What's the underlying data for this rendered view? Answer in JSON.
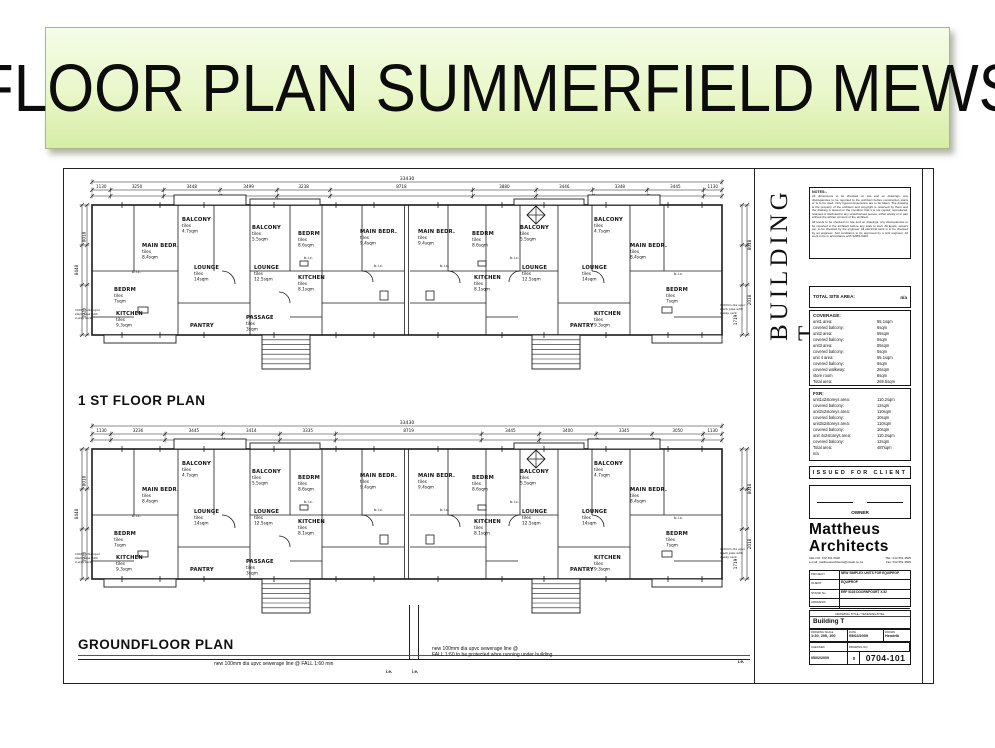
{
  "slide": {
    "title": "FLOOR PLAN SUMMERFIELD MEWS"
  },
  "drawing": {
    "building_label": "BUILDING T",
    "finish_label": "tiles",
    "plans": [
      {
        "name": "1 ST FLOOR PLAN",
        "dim_overall": "33430",
        "dims_top": [
          "1130",
          "3250",
          "3448",
          "3499",
          "3238",
          "8718",
          "3880",
          "3446",
          "3348",
          "3445",
          "1130"
        ],
        "dims_left": [
          "8448",
          "8018",
          "1925"
        ],
        "dims_right": [
          "8018",
          "2018",
          "1719"
        ],
        "compass": true,
        "bic_label": "b.i.c.",
        "bic": [
          [
            58,
            98
          ],
          [
            230,
            84
          ],
          [
            300,
            92
          ],
          [
            366,
            92
          ],
          [
            436,
            84
          ],
          [
            600,
            100
          ]
        ],
        "pipe_note": [
          "100mm dia upvc",
          "stack pipe with",
          "2-way vent"
        ],
        "rooms": [
          {
            "t": "BALCONY",
            "a": "4.7sqm",
            "x": 108,
            "y": 46
          },
          {
            "t": "MAIN BEDR.",
            "a": "8.4sqm",
            "x": 68,
            "y": 72
          },
          {
            "t": "LOUNGE",
            "a": "14sqm",
            "x": 120,
            "y": 94
          },
          {
            "t": "BEDRM",
            "a": "7sqm",
            "x": 40,
            "y": 116
          },
          {
            "t": "KITCHEN",
            "a": "9.3sqm",
            "x": 42,
            "y": 140
          },
          {
            "t": "BALCONY",
            "a": "5.5sqm",
            "x": 178,
            "y": 54
          },
          {
            "t": "LOUNGE",
            "a": "12.5sqm",
            "x": 180,
            "y": 94
          },
          {
            "t": "PASSAGE",
            "a": "3sqm",
            "x": 172,
            "y": 144
          },
          {
            "t": "BEDRM",
            "a": "8.6sqm",
            "x": 224,
            "y": 60
          },
          {
            "t": "KITCHEN",
            "a": "8.1sqm",
            "x": 224,
            "y": 104
          },
          {
            "t": "MAIN BEDR.",
            "a": "9.4sqm",
            "x": 286,
            "y": 58
          },
          {
            "t": "MAIN BEDR.",
            "a": "9.4sqm",
            "x": 344,
            "y": 58
          },
          {
            "t": "BEDRM",
            "a": "8.6sqm",
            "x": 398,
            "y": 60
          },
          {
            "t": "KITCHEN",
            "a": "8.1sqm",
            "x": 400,
            "y": 104
          },
          {
            "t": "BALCONY",
            "a": "5.5sqm",
            "x": 446,
            "y": 54
          },
          {
            "t": "LOUNGE",
            "a": "12.5sqm",
            "x": 448,
            "y": 94
          },
          {
            "t": "BALCONY",
            "a": "4.7sqm",
            "x": 520,
            "y": 46
          },
          {
            "t": "LOUNGE",
            "a": "14sqm",
            "x": 508,
            "y": 94
          },
          {
            "t": "MAIN BEDR.",
            "a": "8.4sqm",
            "x": 556,
            "y": 72
          },
          {
            "t": "BEDRM",
            "a": "7sqm",
            "x": 592,
            "y": 116
          },
          {
            "t": "KITCHEN",
            "a": "9.3sqm",
            "x": 520,
            "y": 140
          },
          {
            "t": "PANTRY",
            "a": null,
            "x": 116,
            "y": 152
          },
          {
            "t": "PANTRY",
            "a": null,
            "x": 496,
            "y": 152
          }
        ]
      },
      {
        "name": "GROUNDFLOOR PLAN",
        "dim_overall": "33430",
        "dims_top": [
          "1130",
          "3236",
          "3445",
          "3414",
          "3335",
          "8719",
          "3445",
          "3400",
          "3345",
          "3050",
          "1130"
        ],
        "dims_left": [
          "8448",
          "8018",
          "1925"
        ],
        "dims_right": [
          "8018",
          "2018",
          "1719"
        ],
        "compass": true,
        "bic_label": "b.i.c.",
        "bic": [
          [
            58,
            98
          ],
          [
            230,
            84
          ],
          [
            300,
            92
          ],
          [
            366,
            92
          ],
          [
            436,
            84
          ],
          [
            600,
            100
          ]
        ],
        "pipe_note": [
          "100mm dia upvc",
          "stack pipe with",
          "2-way vent"
        ],
        "rooms": [
          {
            "t": "BALCONY",
            "a": "4.7sqm",
            "x": 108,
            "y": 46
          },
          {
            "t": "MAIN BEDR.",
            "a": "8.4sqm",
            "x": 68,
            "y": 72
          },
          {
            "t": "LOUNGE",
            "a": "14sqm",
            "x": 120,
            "y": 94
          },
          {
            "t": "BEDRM",
            "a": "7sqm",
            "x": 40,
            "y": 116
          },
          {
            "t": "KITCHEN",
            "a": "9.3sqm",
            "x": 42,
            "y": 140
          },
          {
            "t": "BALCONY",
            "a": "5.5sqm",
            "x": 178,
            "y": 54
          },
          {
            "t": "LOUNGE",
            "a": "12.5sqm",
            "x": 180,
            "y": 94
          },
          {
            "t": "PASSAGE",
            "a": "3sqm",
            "x": 172,
            "y": 144
          },
          {
            "t": "BEDRM",
            "a": "8.6sqm",
            "x": 224,
            "y": 60
          },
          {
            "t": "KITCHEN",
            "a": "8.1sqm",
            "x": 224,
            "y": 104
          },
          {
            "t": "MAIN BEDR.",
            "a": "9.4sqm",
            "x": 286,
            "y": 58
          },
          {
            "t": "MAIN BEDR.",
            "a": "9.4sqm",
            "x": 344,
            "y": 58
          },
          {
            "t": "BEDRM",
            "a": "8.6sqm",
            "x": 398,
            "y": 60
          },
          {
            "t": "KITCHEN",
            "a": "8.1sqm",
            "x": 400,
            "y": 104
          },
          {
            "t": "BALCONY",
            "a": "5.5sqm",
            "x": 446,
            "y": 54
          },
          {
            "t": "LOUNGE",
            "a": "12.5sqm",
            "x": 448,
            "y": 94
          },
          {
            "t": "BALCONY",
            "a": "4.7sqm",
            "x": 520,
            "y": 46
          },
          {
            "t": "LOUNGE",
            "a": "14sqm",
            "x": 508,
            "y": 94
          },
          {
            "t": "MAIN BEDR.",
            "a": "8.4sqm",
            "x": 556,
            "y": 72
          },
          {
            "t": "BEDRM",
            "a": "7sqm",
            "x": 592,
            "y": 116
          },
          {
            "t": "KITCHEN",
            "a": "9.3sqm",
            "x": 520,
            "y": 140
          },
          {
            "t": "PANTRY",
            "a": null,
            "x": 116,
            "y": 152
          },
          {
            "t": "PANTRY",
            "a": null,
            "x": 496,
            "y": 152
          }
        ]
      }
    ],
    "bottom_notes": {
      "note1": "new 100mm dia upvc sewerage line @ FALL 1:60 min",
      "note2_line1": "new 100mm dia upvc sewerage line @",
      "note2_line2": "FALL 1:60 to be protected whre running under building",
      "ie": "i.e."
    },
    "titleblock": {
      "notes_heading": "NOTES:-",
      "notes_paragraphs": [
        "All dimensions to be checked on site and on drawings, any discrepancies to be reported to the architect before construction starts or is to be used. Only figured dimensions are to be taken. The drawing is the property of the architect and copyright is reserved by them and the drawing is issued on the condition that it is not copied, reproduced, retained or disclosed to any unauthorised person, either wholly or in part without the written consent of the architect.",
        "All levels to be checked on site and on drawings, any discrepancies to be reported to the architect before any work to start. All levels, sewers etc. to be checked by the engineer. All electrical work is to be checked by an engineer. Soil conditions to be approved by a civil engineer. All work to be in accordance with SABS 0400."
      ],
      "total_site_label": "TOTAL SITE AREA:",
      "total_site_value": "n/a",
      "coverage_heading": "COVERAGE:",
      "coverage_rows": [
        [
          "unit1 area:",
          "55.1sqm"
        ],
        [
          "covered balcony:",
          "6sqm"
        ],
        [
          "unit2 area:",
          "55sqm"
        ],
        [
          "covered balcony:",
          "5sqm"
        ],
        [
          "unit3 area:",
          "55sqm"
        ],
        [
          "covered balcony:",
          "5sqm"
        ],
        [
          "unit 4 area:",
          "55.1sqm"
        ],
        [
          "covered balcony:",
          "6sqm"
        ],
        [
          "covered walkway:",
          "26sqm"
        ],
        [
          "store room",
          "8sqm"
        ],
        [
          "Total area:",
          "269.5sqm"
        ]
      ],
      "fsr_heading": "FSR:",
      "fsr_rows": [
        [
          "unit1x2storeys area:",
          "110.2sqm"
        ],
        [
          "covered balcony:",
          "12sqm"
        ],
        [
          "unit2x2storeys area:",
          "110sqm"
        ],
        [
          "covered balcony:",
          "10sqm"
        ],
        [
          "unit3x2storeys area:",
          "110sqm"
        ],
        [
          "covered balcony:",
          "10sqm"
        ],
        [
          "unit 4x2storeys area:",
          "110.2sqm"
        ],
        [
          "covered balcony:",
          "12sqm"
        ],
        [
          "Total area:",
          "487sqm"
        ],
        [
          "n/a",
          ""
        ]
      ],
      "issued": "ISSUED FOR CLIENT",
      "owner": "OWNER",
      "firm_line1": "Mattheus",
      "firm_line2": "Architects",
      "contact_cel": "CEL NO: 072 461 6620",
      "contact_tel": "TEL: 012 551 4505",
      "contact_email": "e-mail: mattheusarchitects@mweb.co.za",
      "contact_fax": "Fax: 012 551 4505",
      "project_rows": [
        [
          "PROJECT",
          "NEW SIMPLEX UNITS FOR EQUIPROP"
        ],
        [
          "CLIENT",
          "EQUIPROP"
        ],
        [
          "STAND No",
          "ERF 5135 DOORNPOORT X.52"
        ],
        [
          "ADDRESS",
          ""
        ]
      ],
      "title_label": "DRAWING TITLE / TEKENINGTITEL",
      "title_value": "Building T",
      "scale_label": "DRAWING SCALE",
      "scale_value": "1:20, 200, 100",
      "date_label": "DATE",
      "date_value": "05/02/2009",
      "drawn_label": "DRAWN",
      "drawn_value": "Hendrik",
      "checked_label": "CHECKED",
      "drawingno_label": "DRAWING NO",
      "passed_value": "05/02/2009",
      "revision": "0",
      "drawing_number": "0704-101"
    }
  }
}
